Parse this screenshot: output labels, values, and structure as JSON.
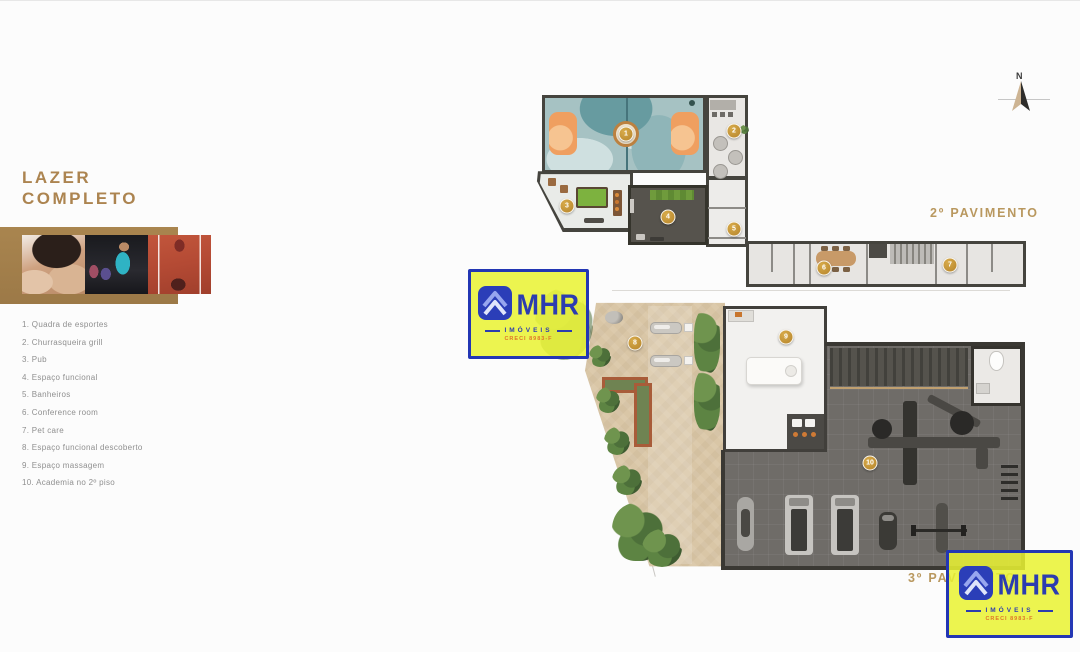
{
  "sidebar": {
    "title": [
      "LAZER",
      "COMPLETO"
    ],
    "amenities": [
      "1. Quadra de esportes",
      "2. Churrasqueira grill",
      "3. Pub",
      "4. Espaço funcional",
      "5. Banheiros",
      "6. Conference room",
      "7. Pet care",
      "8. Espaço funcional descoberto",
      "9. Espaço massagem",
      "10. Academia no 2º piso"
    ]
  },
  "plans": {
    "floor2_label": "2º PAVIMENTO",
    "floor3_label": "3º PAVIMENTO",
    "marker_labels": [
      "1",
      "2",
      "3",
      "4",
      "5",
      "6",
      "7",
      "8",
      "9",
      "10"
    ]
  },
  "compass": {
    "north_label": "N"
  },
  "watermark": {
    "brand": "MHR",
    "subtitle": "IMÓVEIS",
    "creci": "CRECI 8983-F"
  },
  "colors": {
    "accent_gold": "#ac8450",
    "plan_label_gold": "#b9985f",
    "logo_yellow": "#e9f232",
    "logo_blue": "#2c3cb0",
    "creci_orange": "#e0762a"
  }
}
